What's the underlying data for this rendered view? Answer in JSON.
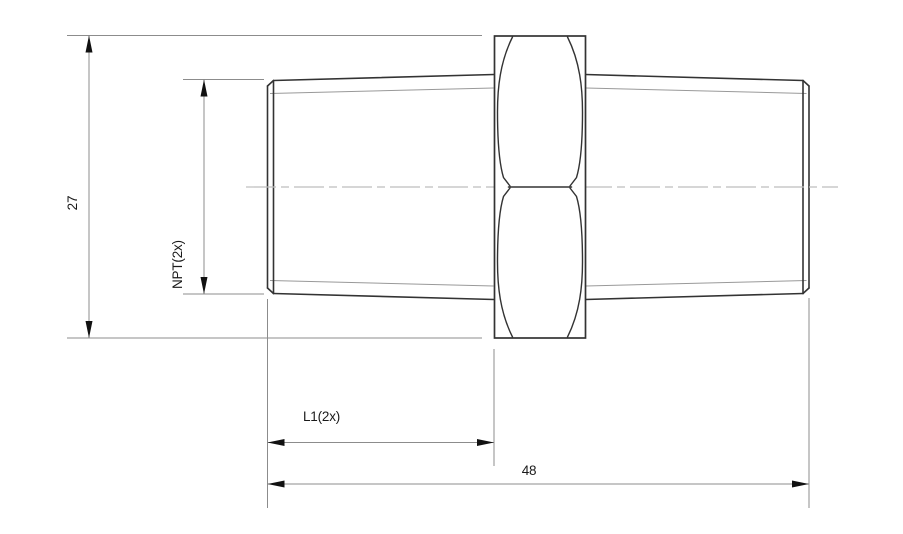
{
  "drawing": {
    "labels": {
      "hex_across_flats": "27",
      "thread_spec": "NPT(2x)",
      "thread_length": "L1(2x)",
      "overall_length": "48"
    },
    "colors": {
      "background": "#ffffff",
      "outline": "#333333",
      "thin_line": "#999999",
      "centerline": "#bdbdbd",
      "dimension_line": "#8c8c8c",
      "arrow": "#111111",
      "text": "#1a1a1a"
    }
  }
}
